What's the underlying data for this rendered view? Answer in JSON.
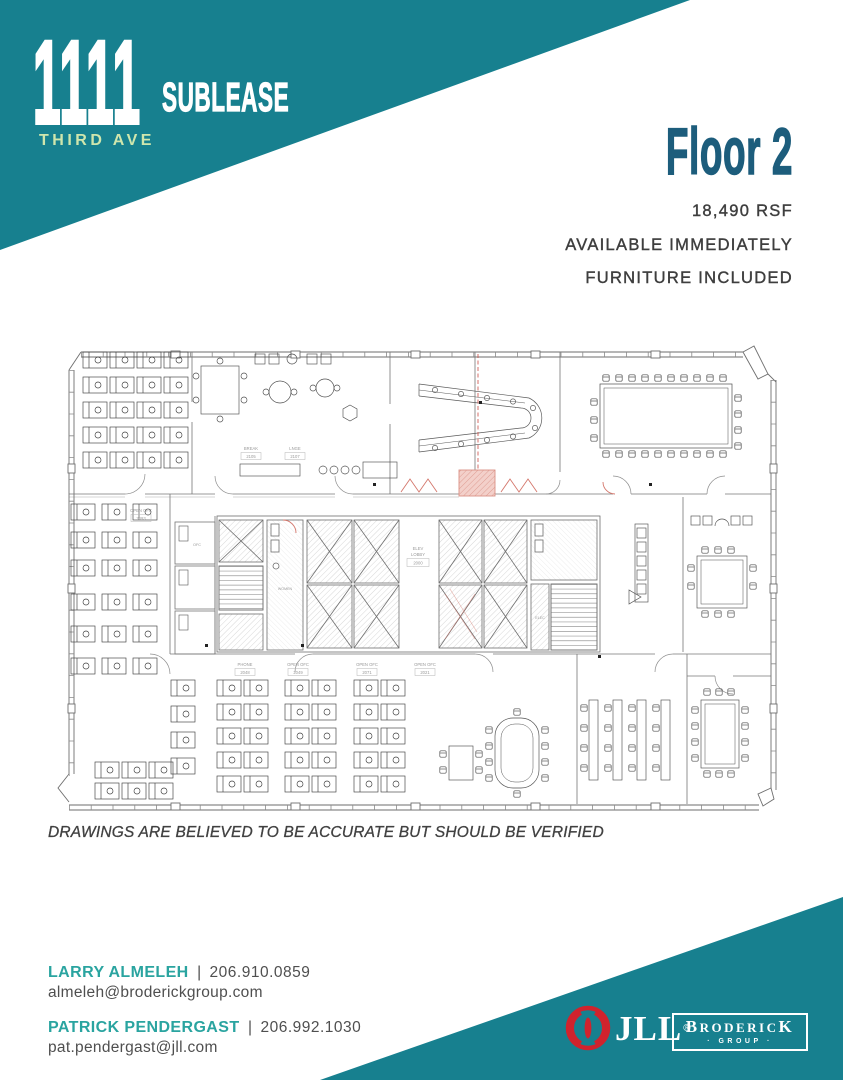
{
  "brand": {
    "number": "1111",
    "street": "THIRD AVE",
    "tagline": "SUBLEASE"
  },
  "listing": {
    "floor": "Floor 2",
    "rsf": "18,490 RSF",
    "availability": "AVAILABLE IMMEDIATELY",
    "furniture": "FURNITURE INCLUDED"
  },
  "floorplan": {
    "disclaimer": "DRAWINGS ARE BELIEVED TO BE ACCURATE BUT SHOULD BE VERIFIED",
    "labels": {
      "break": "BREAK",
      "break_num": "2105",
      "lounge": "LNGE",
      "lounge_num": "2107",
      "elev": "ELEV",
      "lobby": "LOBBY",
      "elev_num": "2000",
      "women": "WOMEN",
      "ofc": "OFC",
      "open_ofc": "OPEN OFC",
      "open_num_1": "2093",
      "open_num_2": "2049",
      "open_num_3": "2071",
      "open_num_4": "2021",
      "phone": "PHONE",
      "phone_num": "2048",
      "elec": "ELEC"
    }
  },
  "contacts": {
    "c1": {
      "name": "LARRY ALMELEH",
      "sep": "|",
      "phone": "206.910.0859",
      "email": "almeleh@broderickgroup.com"
    },
    "c2": {
      "name": "PATRICK PENDERGAST",
      "sep": "|",
      "phone": "206.992.1030",
      "email": "pat.pendergast@jll.com"
    }
  },
  "logos": {
    "jll": "JLL",
    "jll_reg": "®",
    "brod_first": "B",
    "brod_mid": "RODERIC",
    "brod_last": "K",
    "brod_sub": "· GROUP ·"
  },
  "colors": {
    "teal": "#17808f",
    "street_green": "#cfe6ad",
    "floor_blue": "#1d5d7c",
    "contact_teal": "#2aa4a0",
    "text_dark": "#3e3e3e",
    "jll_red": "#d0232d",
    "plan_red": "#d4766b"
  }
}
